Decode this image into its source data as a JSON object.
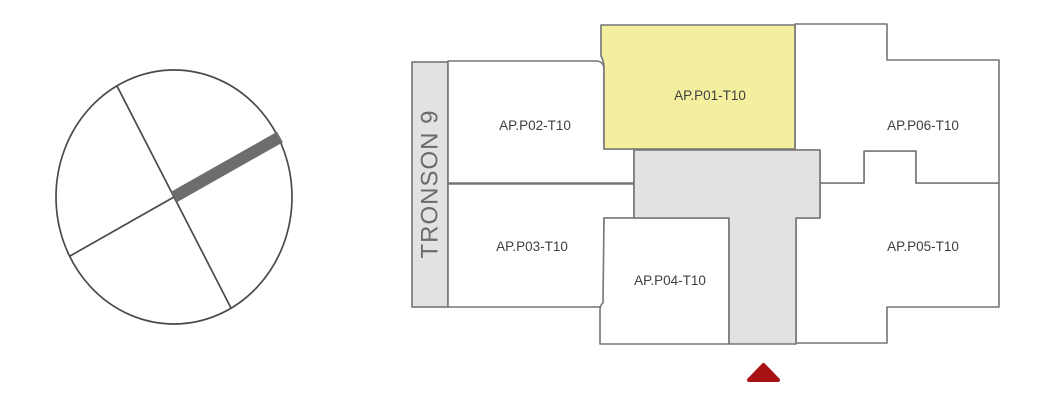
{
  "section": {
    "label": "TRONSON 9"
  },
  "apartments": [
    {
      "id": "AP.P01-T10",
      "label": "AP.P01-T10",
      "highlighted": true
    },
    {
      "id": "AP.P02-T10",
      "label": "AP.P02-T10",
      "highlighted": false
    },
    {
      "id": "AP.P03-T10",
      "label": "AP.P03-T10",
      "highlighted": false
    },
    {
      "id": "AP.P04-T10",
      "label": "AP.P04-T10",
      "highlighted": false
    },
    {
      "id": "AP.P05-T10",
      "label": "AP.P05-T10",
      "highlighted": false
    },
    {
      "id": "AP.P06-T10",
      "label": "AP.P06-T10",
      "highlighted": false
    }
  ],
  "colors": {
    "highlight_fill": "#f4ef9f",
    "core_fill": "#e2e2e2",
    "outline": "#757575",
    "marker": "#a81212",
    "compass_stroke": "#4a4a4a",
    "compass_wing": "#6d6d6d"
  }
}
